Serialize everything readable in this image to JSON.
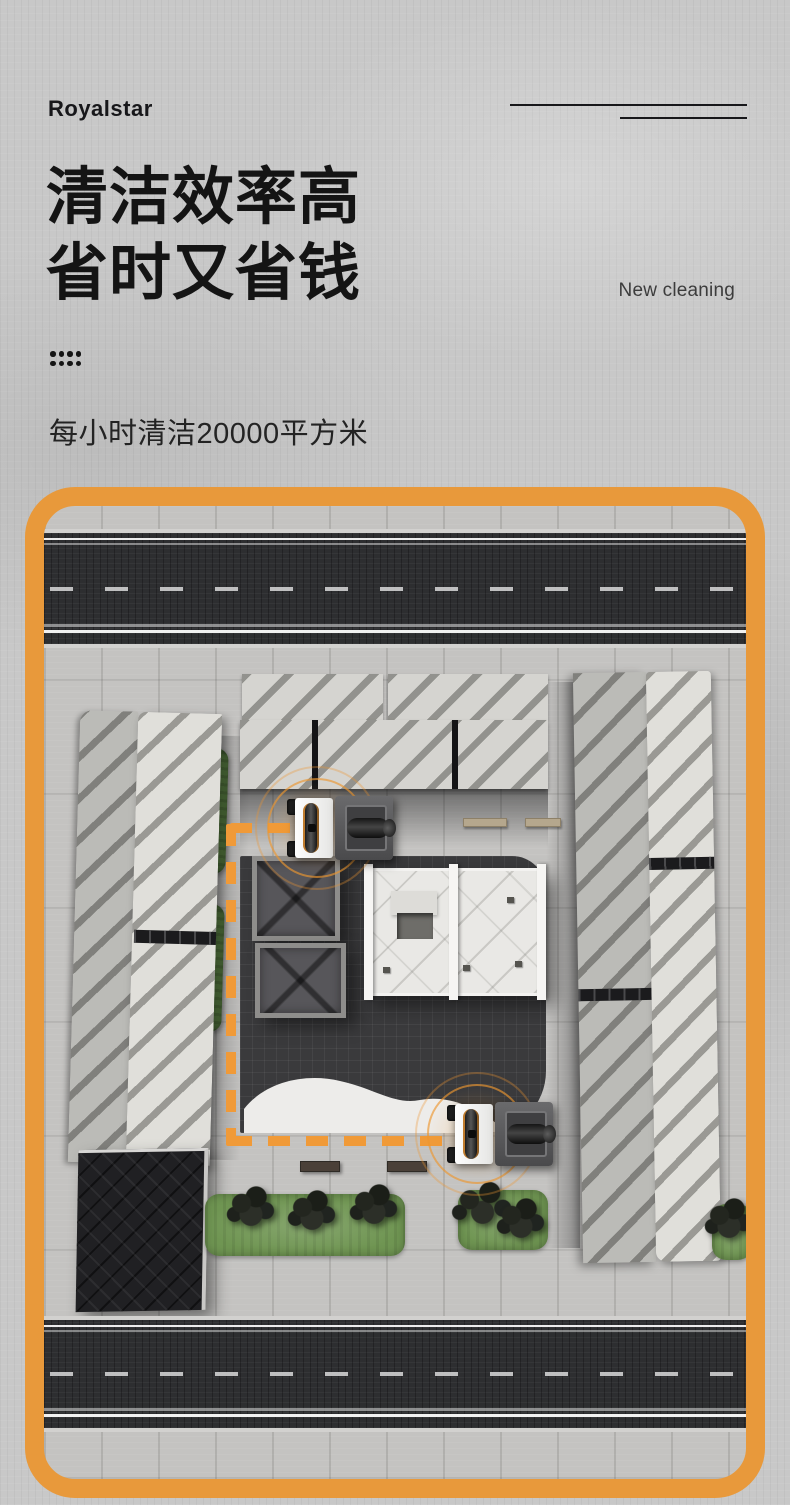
{
  "header": {
    "brand": "Royalstar",
    "title_line1": "清洁效率高",
    "title_line2": "省时又省钱",
    "tagline_en": "New cleaning",
    "subtitle": "每小时清洁20000平方米"
  },
  "colors": {
    "accent": "#E8993B",
    "path": "#F09A38",
    "heading": "#141414",
    "text": "#3C3C3C",
    "page_bg": "#C8C8C8",
    "paving": "#C4C3C1",
    "road": "#2D2E30",
    "plaza": "#3A3A3C",
    "green": "#6F9552",
    "building_light": "#D5D4D0",
    "building_stripe": "#9C9B96",
    "building_dark": "#202023",
    "machine_body": "#5A5A5C",
    "machine_front": "#F4F4F3"
  },
  "scene": {
    "machine_labels": [
      "cleaning-machine-1",
      "cleaning-machine-2"
    ]
  }
}
